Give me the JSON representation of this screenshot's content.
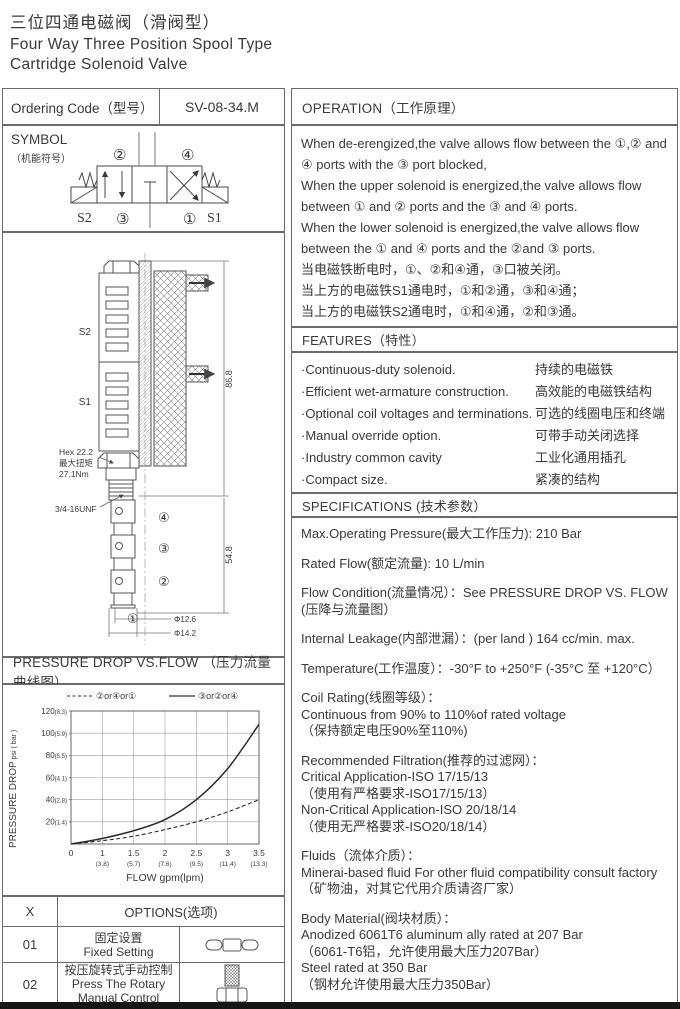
{
  "header": {
    "title_zh": "三位四通电磁阀（滑阀型）",
    "title_en1": "Four Way Three Position Spool Type",
    "title_en2": "Cartridge Solenoid Valve"
  },
  "ordering": {
    "label": "Ordering Code（型号）",
    "code": "SV-08-34.M"
  },
  "symbol": {
    "heading": "SYMBOL",
    "subheading": "（机能符号）",
    "port2": "②",
    "port4": "④",
    "port3": "③",
    "port1": "①",
    "sol_left": "S2",
    "sol_right": "S1"
  },
  "drawing": {
    "coil_top": "S2",
    "coil_bottom": "S1",
    "hex_line1": "Hex 22.2",
    "hex_line2": "最大扭矩",
    "hex_line3": "27.1Nm",
    "thread": "3/4-16UNF",
    "dim_upper": "86.8",
    "dim_lower": "54.8",
    "dia1": "Φ12.6",
    "dia2": "Φ14.2",
    "port4": "④",
    "port3": "③",
    "port2": "②",
    "port1": "①"
  },
  "operation": {
    "heading": "OPERATION（工作原理）",
    "lines": [
      "When de-erengized,the valve allows flow between the ①,② and ④ ports with the ③ port blocked,",
      "When the upper solenoid is energized,the valve allows flow between ① and ② ports and the ③ and ④ ports.",
      "When the lower solenoid is energized,the valve allows flow between the ① and ④ ports and the ②and ③ ports.",
      "当电磁铁断电时，①、②和④通，③口被关闭。",
      "当上方的电磁铁S1通电时，①和②通，③和④通；",
      "当上方的电磁铁S2通电时，①和④通，②和③通。"
    ]
  },
  "features": {
    "heading": "FEATURES（特性）",
    "items": [
      {
        "en": "·Continuous-duty  solenoid.",
        "zh": "持续的电磁铁"
      },
      {
        "en": "·Efficient wet-armature construction.",
        "zh": "高效能的电磁铁结构"
      },
      {
        "en": "·Optional coil voltages and terminations.",
        "zh": "可选的线圈电压和终端"
      },
      {
        "en": "·Manual override option.",
        "zh": "可带手动关闭选择"
      },
      {
        "en": "·Industry common cavity",
        "zh": "工业化通用插孔"
      },
      {
        "en": "·Compact size.",
        "zh": "紧凑的结构"
      }
    ]
  },
  "specifications": {
    "heading": "SPECIFICATIONS (技术参数）",
    "blocks": [
      [
        "Max.Operating Pressure(最大工作压力): 210 Bar"
      ],
      [
        "Rated Flow(额定流量): 10 L/min"
      ],
      [
        "Flow Condition(流量情况）：See PRESSURE DROP VS. FLOW",
        "(压降与流量图）"
      ],
      [
        "Internal Leakage(内部泄漏）：(per land ) 164 cc/min. max."
      ],
      [
        "Temperature(工作温度）：-30°F to +250°F  (-35°C 至 +120°C）"
      ],
      [
        "Coil Rating(线圈等级）：",
        "Continuous from 90% to 110%of rated voltage",
        "（保持额定电压90%至110%)"
      ],
      [
        "Recommended Filtration(推荐的过滤网）：",
        "Critical Application-ISO 17/15/13",
        "（使用有严格要求-ISO17/15/13）",
        "Non-Critical Application-ISO 20/18/14",
        "（使用无严格要求-ISO20/18/14）"
      ],
      [
        "Fluids（流体介质）：",
        "Minerai-based fluid For other  fluid compatibility consult  factory",
        "（矿物油，对其它代用介质请咨厂家）"
      ],
      [
        "Body Material(阀块材质）：",
        "Anodized 6061T6 aluminum ally rated at 207 Bar",
        "（6061-T6铝，允许使用最大压力207Bar）",
        "Steel rated at 350 Bar",
        "（钢材允许使用最大压力350Bar）"
      ]
    ]
  },
  "pressure_chart": {
    "heading": "PRESSURE DROP VS.FLOW （压力流量曲线图）"
  },
  "chart_data": {
    "type": "line",
    "title": "PRESSURE DROP VS.FLOW （压力流量曲线图）",
    "xlabel": "FLOW gpm(lpm)",
    "ylabel_main": "PRESSURE DROP",
    "ylabel_unit": " psi ( bar )",
    "x_tick_labels": [
      "0",
      "1",
      "1.5",
      "2",
      "2.5",
      "3",
      "3.5"
    ],
    "x_tick_sublabels": [
      "",
      "(3.8)",
      "(5.7)",
      "(7.6)",
      "(9.5)",
      "(11.4)",
      "(13.3)"
    ],
    "y_ticks": [
      {
        "psi": "20",
        "bar": "(1.4)"
      },
      {
        "psi": "40",
        "bar": "(2.8)"
      },
      {
        "psi": "60",
        "bar": "(4.1)"
      },
      {
        "psi": "80",
        "bar": "(5.5)"
      },
      {
        "psi": "100",
        "bar": "(5.9)"
      },
      {
        "psi": "120",
        "bar": "(8.3)"
      }
    ],
    "ylim": [
      0,
      120
    ],
    "grid": true,
    "legend_position": "top",
    "series": [
      {
        "name": "②or④or①",
        "style": "dashed",
        "values_psi": [
          0,
          3,
          7,
          13,
          20,
          29,
          40
        ]
      },
      {
        "name": "③or②or④",
        "style": "solid",
        "values_psi": [
          0,
          5,
          12,
          22,
          40,
          68,
          108
        ]
      }
    ]
  },
  "options": {
    "col_x": "X",
    "col_options": "OPTIONS(选项)",
    "rows": [
      {
        "code": "01",
        "zh": "固定设置",
        "en": "Fixed Setting",
        "icon": "triple-nut-icon"
      },
      {
        "code": "02",
        "zh": "按压旋转式手动控制",
        "en": "Press The Rotary Manual Control",
        "icon": "knurled-knob-icon"
      }
    ]
  },
  "colors": {
    "ink": "#3a3a3a",
    "line": "#6b6b6b",
    "grid": "#999999",
    "curve": "#2a2a2a"
  }
}
